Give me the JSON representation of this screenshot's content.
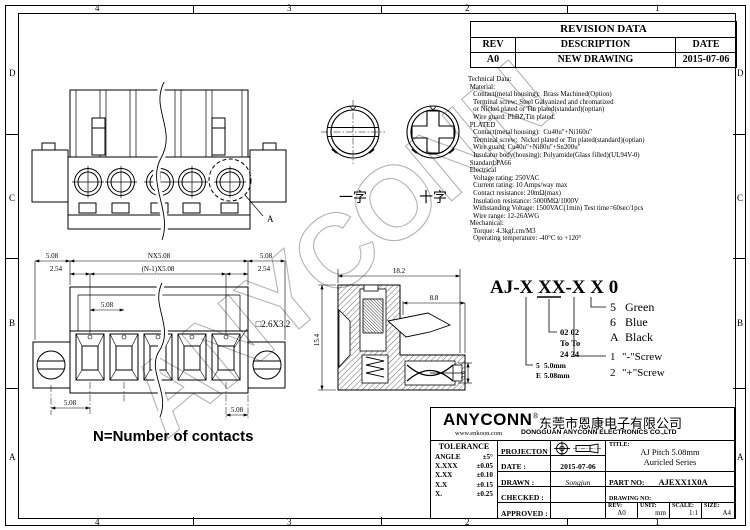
{
  "frame": {
    "top_labels": [
      "4",
      "3",
      "2",
      "1"
    ],
    "bottom_labels": [
      "4",
      "3",
      "2",
      "1"
    ],
    "left_labels": [
      "D",
      "C",
      "B",
      "A"
    ],
    "right_labels": [
      "D",
      "C",
      "B",
      "A"
    ]
  },
  "watermark": "ANYCONN",
  "revision_table": {
    "title": "REVISION DATA",
    "col_rev": "REV",
    "col_desc": "DESCRIPTION",
    "col_date": "DATE",
    "row": {
      "rev": "A0",
      "desc": "NEW DRAWING",
      "date": "2015-07-06"
    }
  },
  "technical_data": {
    "lines": [
      "Technical Data:",
      " Material:",
      "   Contact(metal housing):  Brass Machined(Option)",
      "   Terminal screw: Steel Galvanized and chromatized",
      "   or Nickel plated or Tin plated(standard)(optian)",
      "   Wire guard: PhBZ,Tin plated.",
      " PLATED",
      "   Contact(metal housing):  Cu40u\"+Ni160u\"",
      "   Terminal screw:  Nickel plated or Tin plated(standard)(optian)",
      "   Wire guard: Cu40u\"+Ni80u\"+Sn200u\"",
      "   Insulator body(housing): Polyamide(Glass filled)(UL94V-0)",
      " Standard:PA66",
      " Electrical",
      "   Voltage rating: 250VAC",
      "   Current rating: 10 Amps/way max",
      "   Contact resistance: 20mΩ(max)",
      "   Insulation resistance: 5000MΩ/1000V",
      "   Withstanding Voltage: 1500VAC(1min) Test time=60sec/1pcs",
      "   Wire range: 12-26AWG",
      " Mechanical:",
      "   Torque: 4.3kgf.cm/M3",
      "   Operating temperature: -40°C to +120°"
    ]
  },
  "screw_views": {
    "flat_label": "一字",
    "cross_label": "十字"
  },
  "pictorial": {
    "detail_label": "A"
  },
  "front_view": {
    "dims": {
      "pitch_left": "5.08",
      "overall": "NX5.08",
      "pitch_right": "5.08",
      "half_left": "2.54",
      "centers": "(N-1)X5.08",
      "half_right": "2.54",
      "inner_pitch": "5.08",
      "slot": "□2.6X3.2",
      "bottom_left": "5.08",
      "bottom_right": "5.08"
    },
    "note": "N=Number of contacts"
  },
  "section_view": {
    "dims": {
      "width": "18.2",
      "depth": "8.8",
      "height": "15.4",
      "tail": "3.6"
    }
  },
  "part_code": {
    "code": "AJ-X XX-X X 0",
    "colors": [
      [
        "5",
        "Green"
      ],
      [
        "6",
        "Blue"
      ],
      [
        "A",
        "Black"
      ]
    ],
    "range": [
      "02 02",
      "To To",
      "24 24"
    ],
    "screws": [
      [
        "1",
        "\"-\"Screw"
      ],
      [
        "2",
        "\"+\"Screw"
      ]
    ],
    "pitch": [
      [
        "5",
        "5.0mm"
      ],
      [
        "E",
        "5.08mm"
      ]
    ]
  },
  "title_block": {
    "brand": "ANYCONN",
    "reg": "®",
    "company_cn": "东莞市恩康电子有限公司",
    "website": "www.enkoon.com",
    "company_en": "DONGGUAN ANYCONN ELECTRONICS CO.,LTD",
    "tolerance": {
      "header": "TOLERANCE",
      "rows": [
        [
          "ANGLE",
          "±5°"
        ],
        [
          "X.XXX",
          "±0.05"
        ],
        [
          "X.XX",
          "±0.10"
        ],
        [
          "X.X",
          "±0.15"
        ],
        [
          "X.",
          "±0.25"
        ]
      ]
    },
    "projection_label": "PROJECTON",
    "date_label": "DATE :",
    "date_value": "2015-07-06",
    "drawn_label": "DRAWN :",
    "drawn_value": "Songjun",
    "checked_label": "CHECKED :",
    "checked_value": "",
    "approved_label": "APPROVED :",
    "approved_value": "",
    "title_label": "TITLE:",
    "title_line1": "AJ Pitch 5.08mm",
    "title_line2": "Auricled Series",
    "part_no_label": "PART NO:",
    "part_no_value": "AJEXX1X0A",
    "drawing_no_label": "DRAWING NO:",
    "rev_label": "REV:",
    "rev_value": "A0",
    "unit_label": "UNIT:",
    "unit_value": "mm",
    "scale_label": "SCALE:",
    "scale_value": "1:1",
    "size_label": "SIZE:",
    "size_value": "A4"
  }
}
